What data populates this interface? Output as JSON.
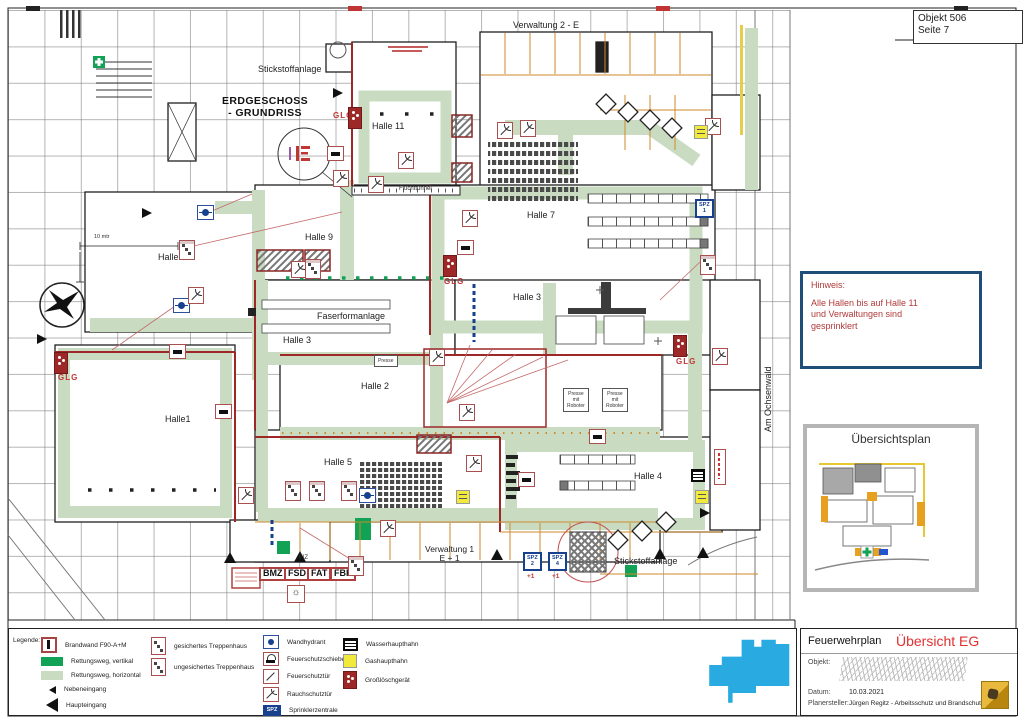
{
  "sheet": {
    "objekt": "Objekt 506",
    "seite": "Seite 7"
  },
  "hinweis": {
    "title": "Hinweis:",
    "body": "Alle Hallen bis auf Halle 11\nund Verwaltungen sind\ngesprinklert"
  },
  "inset": {
    "title": "Übersichtsplan"
  },
  "title_block": {
    "doc_type": "Feuerwehrplan",
    "doc_title": "Übersicht EG",
    "objekt_label": "Objekt:",
    "datum_label": "Datum:",
    "datum": "10.03.2021",
    "planer_label": "Planersteller:",
    "planer": "Jürgen Regitz - Arbeitsschutz und Brandschutz"
  },
  "legend": {
    "label": "Legende:",
    "columns": [
      [
        {
          "icon": "brandwand",
          "label": "Brandwand F90-A+M"
        },
        {
          "icon": "rwv",
          "label": "Rettungsweg, vertikal"
        },
        {
          "icon": "rwh",
          "label": "Rettungsweg, horizontal"
        },
        {
          "icon": "neben",
          "label": "Nebeneingang"
        },
        {
          "icon": "haupt",
          "label": "Haupteingang"
        }
      ],
      [
        {
          "icon": "t1",
          "label": "gesichertes Treppenhaus"
        },
        {
          "icon": "t2",
          "label": "ungesichertes Treppenhaus"
        }
      ],
      [
        {
          "icon": "hydrant",
          "label": "Wandhydrant"
        },
        {
          "icon": "schiebetor",
          "label": "Feuerschutzschiebetor"
        },
        {
          "icon": "fstuer",
          "label": "Feuerschutztür"
        },
        {
          "icon": "rstuer",
          "label": "Rauchschutztür"
        },
        {
          "icon": "spz",
          "glyph": "SPZ",
          "label": "Sprinklerzentrale"
        }
      ],
      [
        {
          "icon": "wasser",
          "label": "Wasserhaupthahn"
        },
        {
          "icon": "gas",
          "label": "Gashaupthahn"
        },
        {
          "icon": "gross",
          "label": "Großlöschgerät"
        }
      ]
    ]
  },
  "plan": {
    "labels": [
      {
        "t": "Verwaltung 2 - E",
        "x": 513,
        "y": 21,
        "c": "lbl"
      },
      {
        "t": "Stickstoffanlage",
        "x": 258,
        "y": 65,
        "c": "lbl"
      },
      {
        "t": "ERDGESCHOSS\n- GRUNDRISS",
        "x": 222,
        "y": 96,
        "c": "head"
      },
      {
        "t": "Halle 11",
        "x": 372,
        "y": 122,
        "c": "lbl"
      },
      {
        "t": "Fluchttunnel",
        "x": 399,
        "y": 186,
        "c": "tiny"
      },
      {
        "t": "Halle 7",
        "x": 527,
        "y": 211,
        "c": "lbl"
      },
      {
        "t": "Halle 9",
        "x": 305,
        "y": 233,
        "c": "lbl"
      },
      {
        "t": "Halle 10",
        "x": 158,
        "y": 253,
        "c": "lbl"
      },
      {
        "t": "10 mtr",
        "x": 94,
        "y": 234,
        "c": "micro"
      },
      {
        "t": "Halle 3",
        "x": 513,
        "y": 293,
        "c": "lbl"
      },
      {
        "t": "Faserformanlage",
        "x": 317,
        "y": 312,
        "c": "lbl"
      },
      {
        "t": "Halle 3",
        "x": 283,
        "y": 336,
        "c": "lbl"
      },
      {
        "t": "Halle 2",
        "x": 361,
        "y": 382,
        "c": "lbl"
      },
      {
        "t": "Halle1",
        "x": 165,
        "y": 415,
        "c": "lbl"
      },
      {
        "t": "Halle 5",
        "x": 324,
        "y": 458,
        "c": "lbl"
      },
      {
        "t": "Halle 4",
        "x": 634,
        "y": 472,
        "c": "lbl"
      },
      {
        "t": "Verwaltung 1\nE + 1",
        "x": 425,
        "y": 545,
        "c": "lblc"
      },
      {
        "t": "Stickstoffanlage",
        "x": 614,
        "y": 557,
        "c": "lbl"
      },
      {
        "t": "FIZ",
        "x": 299,
        "y": 555,
        "c": "tiny"
      },
      {
        "t": "Am Ochsenwald",
        "x": 764,
        "y": 432,
        "c": "vert"
      },
      {
        "t": "GLG",
        "x": 333,
        "y": 112,
        "c": "glg"
      },
      {
        "t": "GLG",
        "x": 444,
        "y": 278,
        "c": "glg"
      },
      {
        "t": "GLG",
        "x": 58,
        "y": 374,
        "c": "glg"
      },
      {
        "t": "GLG",
        "x": 676,
        "y": 358,
        "c": "glg"
      },
      {
        "t": "+1",
        "x": 527,
        "y": 573,
        "c": "plus"
      },
      {
        "t": "+1",
        "x": 552,
        "y": 573,
        "c": "plus"
      },
      {
        "t": "Presse",
        "x": 374,
        "y": 355,
        "c": "boxed"
      },
      {
        "t": "Presse\nmit\nRoboter",
        "x": 563,
        "y": 388,
        "c": "boxed"
      },
      {
        "t": "Presse\nmit\nRoboter",
        "x": 602,
        "y": 388,
        "c": "boxed"
      },
      {
        "t": "BMZ",
        "x": 259,
        "y": 567,
        "c": "redbox"
      },
      {
        "t": "FSD",
        "x": 284,
        "y": 567,
        "c": "redbox"
      },
      {
        "t": "FAT",
        "x": 307,
        "y": 567,
        "c": "redbox"
      },
      {
        "t": "FBF",
        "x": 330,
        "y": 567,
        "c": "redbox"
      },
      {
        "t": "SPZ\n1",
        "x": 695,
        "y": 199,
        "c": "spz"
      },
      {
        "t": "SPZ\n2",
        "x": 523,
        "y": 552,
        "c": "spz"
      },
      {
        "t": "SPZ\n4",
        "x": 548,
        "y": 552,
        "c": "spz"
      }
    ],
    "icons": [
      {
        "t": "hydrant",
        "x": 197,
        "y": 205
      },
      {
        "t": "hydrant",
        "x": 173,
        "y": 298
      },
      {
        "t": "hydrant",
        "x": 359,
        "y": 488
      },
      {
        "t": "firedoor",
        "x": 398,
        "y": 152
      },
      {
        "t": "firedoor",
        "x": 333,
        "y": 170
      },
      {
        "t": "firedoor",
        "x": 368,
        "y": 176
      },
      {
        "t": "firedoor",
        "x": 291,
        "y": 261
      },
      {
        "t": "firedoor",
        "x": 497,
        "y": 122
      },
      {
        "t": "firedoor",
        "x": 462,
        "y": 210
      },
      {
        "t": "firedoor",
        "x": 429,
        "y": 349
      },
      {
        "t": "firedoor",
        "x": 459,
        "y": 404
      },
      {
        "t": "firedoor",
        "x": 380,
        "y": 520
      },
      {
        "t": "firedoor",
        "x": 705,
        "y": 118
      },
      {
        "t": "firedoor",
        "x": 520,
        "y": 120
      },
      {
        "t": "firedoor",
        "x": 188,
        "y": 287
      },
      {
        "t": "firedoor",
        "x": 712,
        "y": 348
      },
      {
        "t": "firedoor",
        "x": 466,
        "y": 455
      },
      {
        "t": "firedoor",
        "x": 238,
        "y": 487
      },
      {
        "t": "tstair",
        "x": 285,
        "y": 481
      },
      {
        "t": "tstair",
        "x": 309,
        "y": 481
      },
      {
        "t": "tstair",
        "x": 341,
        "y": 481
      },
      {
        "t": "tstair",
        "x": 179,
        "y": 240
      },
      {
        "t": "tstair",
        "x": 305,
        "y": 259
      },
      {
        "t": "tstair",
        "x": 348,
        "y": 556
      },
      {
        "t": "tstair",
        "x": 700,
        "y": 255
      },
      {
        "t": "slidedoor",
        "x": 327,
        "y": 146
      },
      {
        "t": "slidedoor",
        "x": 457,
        "y": 240
      },
      {
        "t": "slidedoor",
        "x": 169,
        "y": 344
      },
      {
        "t": "slidedoor",
        "x": 215,
        "y": 404
      },
      {
        "t": "slidedoor",
        "x": 589,
        "y": 429
      },
      {
        "t": "slidedoor",
        "x": 518,
        "y": 472
      },
      {
        "t": "glg",
        "x": 348,
        "y": 107
      },
      {
        "t": "glg",
        "x": 443,
        "y": 255
      },
      {
        "t": "glg",
        "x": 54,
        "y": 352
      },
      {
        "t": "glg",
        "x": 673,
        "y": 335
      },
      {
        "t": "gas",
        "x": 694,
        "y": 125
      },
      {
        "t": "gas",
        "x": 456,
        "y": 490
      },
      {
        "t": "gas",
        "x": 695,
        "y": 490
      },
      {
        "t": "water",
        "x": 691,
        "y": 469
      },
      {
        "t": "redvert",
        "x": 714,
        "y": 449
      },
      {
        "t": "lamp",
        "x": 287,
        "y": 585
      }
    ]
  },
  "colors": {
    "escape_route": "#c9dcc2",
    "escape_vertical": "#12a256",
    "brandwand": "#9e2828",
    "accent_blue": "#17408f",
    "accent_yellow": "#f1e93c",
    "accent_red": "#c23535",
    "cyan_footprint": "#29abe2"
  }
}
